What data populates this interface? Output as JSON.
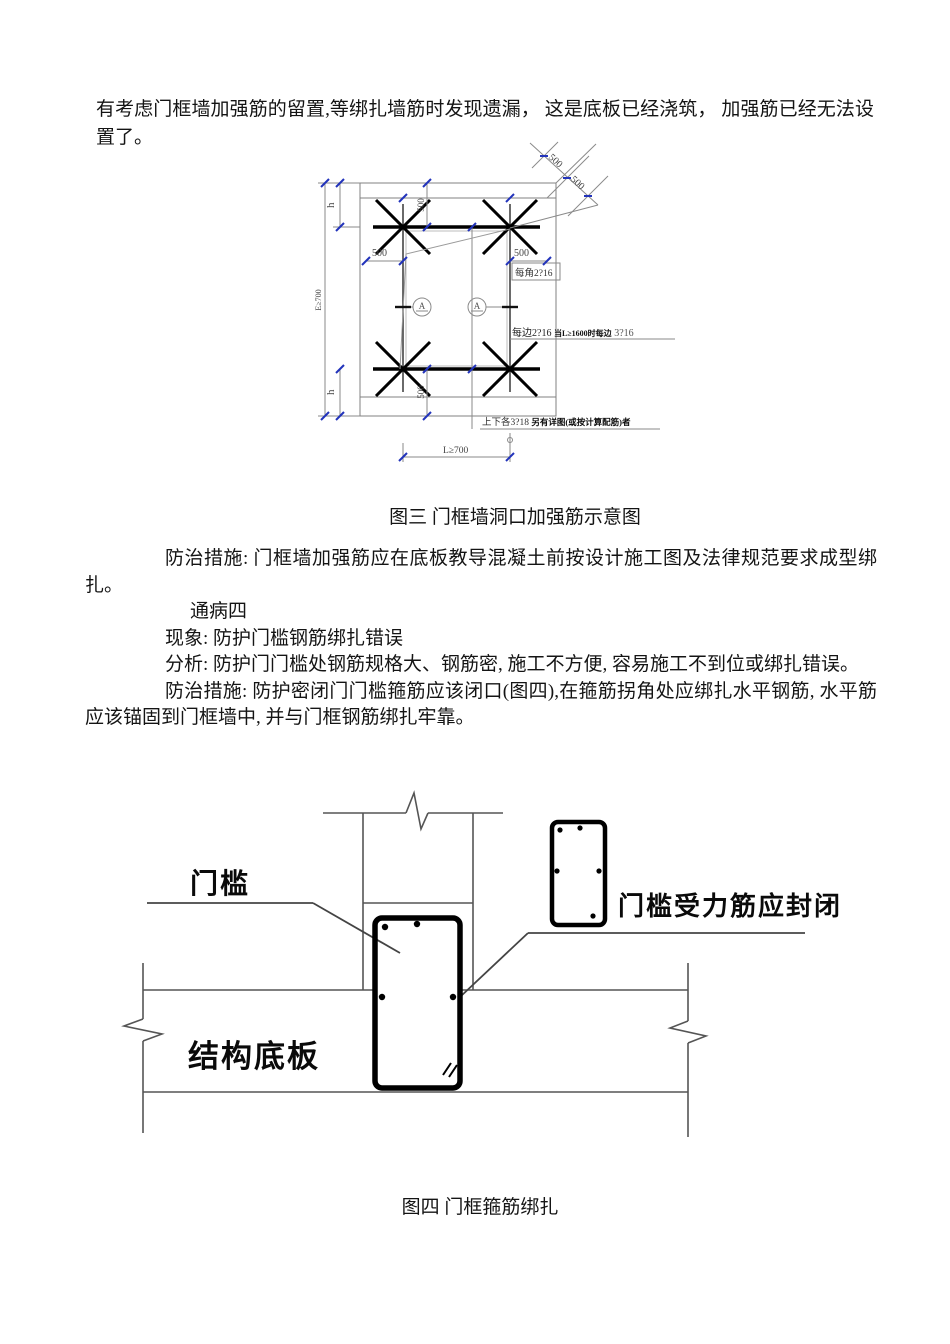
{
  "document": {
    "para1": "有考虑门框墙加强筋的留置,等绑扎墙筋时发现遗漏， 这是底板已经浇筑， 加强筋已经无法设置了。",
    "para_measures1": "防治措施: 门框墙加强筋应在底板教导混凝土前按设计施工图及法律规范要求成型绑扎。",
    "para_disease4": "通病四",
    "para_phenomenon": "现象: 防护门槛钢筋绑扎错误",
    "para_analysis": "分析: 防护门门槛处钢筋规格大、钢筋密, 施工不方便, 容易施工不到位或绑扎错误。",
    "para_measures2": "防治措施: 防护密闭门门槛箍筋应该闭口(图四),在箍筋拐角处应绑扎水平钢筋, 水平筋应该锚固到门框墙中, 并与门框钢筋绑扎牢靠。"
  },
  "figure3": {
    "caption": "图三 门框墙洞口加强筋示意图",
    "labels": {
      "h_dim": "h",
      "height_dim": "E≥700",
      "dim500": "500",
      "corner_label": "每角2?16",
      "side_label_a": "每边2?16",
      "side_label_b": "当L≥1600时每边",
      "side_label_c": "3?16",
      "bottom_note_a": "上下各3?18",
      "bottom_note_b": "另有详图(或按计算配筋)者",
      "width_dim": "L≥700",
      "section_mark": "A"
    }
  },
  "figure4": {
    "caption": "图四 门框箍筋绑扎",
    "labels": {
      "sill": "门槛",
      "closed_note": "门槛受力筋应封闭",
      "slab": "结构底板"
    }
  },
  "colors": {
    "tick_blue": "#2233bb",
    "thin_line": "#808080",
    "bar_black": "#000000"
  }
}
